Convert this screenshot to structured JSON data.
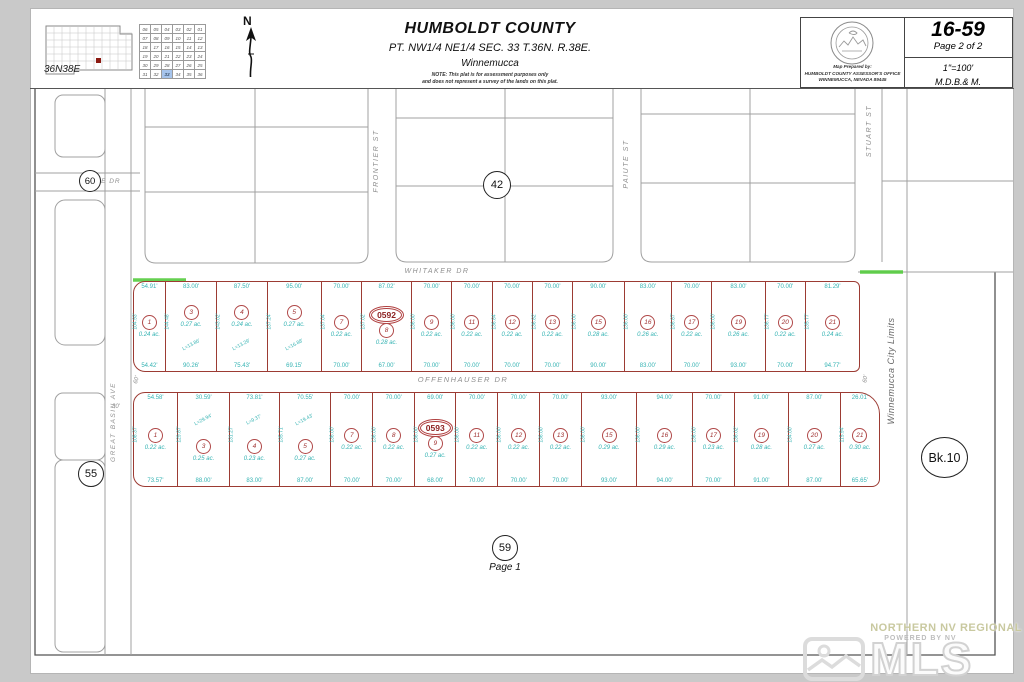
{
  "header": {
    "township_label": "36N38E",
    "north_label": "N",
    "section_grid": {
      "rows": [
        [
          "06",
          "05",
          "04",
          "03",
          "02",
          "01"
        ],
        [
          "07",
          "08",
          "09",
          "10",
          "11",
          "12"
        ],
        [
          "18",
          "17",
          "16",
          "15",
          "14",
          "13"
        ],
        [
          "19",
          "20",
          "21",
          "22",
          "23",
          "24"
        ],
        [
          "30",
          "29",
          "28",
          "27",
          "26",
          "25"
        ],
        [
          "31",
          "32",
          "33",
          "34",
          "35",
          "36"
        ]
      ],
      "highlight": "33"
    },
    "title": "HUMBOLDT COUNTY",
    "subtitle": "PT. NW1/4 NE1/4 SEC. 33 T.36N. R.38E.",
    "city": "Winnemucca",
    "note1": "NOTE: This plat is for assessment purposes only",
    "note2": "and does not represent a survey of the lands on this plat.",
    "prepared1": "Map Prepared by:",
    "prepared2": "HUMBOLDT COUNTY ASSESSOR'S OFFICE",
    "prepared3": "WINNEMUCCA, NEVADA    89445",
    "map_number": "16-59",
    "page": "Page 2 of 2",
    "scale": "1\"=100'",
    "meridian": "M.D.B.& M."
  },
  "streets": {
    "whitaker": "WHITAKER DR",
    "offenhauser": "OFFENHAUSER DR",
    "frontier": "FRONTIER ST",
    "paiute": "PAIUTE ST",
    "stuart": "STUART ST",
    "great_basin": "GREAT BASIN AVE",
    "maple": "MAPLE DR"
  },
  "refs": {
    "north_map": "42",
    "west_map": "55",
    "south_map": "59",
    "south_page": "Page 1",
    "northwest_map": "60",
    "book": "Bk.10"
  },
  "city_limits": "Winnemucca City Limits",
  "dims": {
    "left_offset": "30'",
    "width_left": "60'",
    "width_right": "60'"
  },
  "blocks": [
    {
      "number": "0592",
      "street": "WHITAKER DR",
      "lots": [
        {
          "n": "1",
          "area": "0.24 ac.",
          "top": "54.91'",
          "bottom": "54.42'",
          "side": "104.93'"
        },
        {
          "n": "3",
          "area": "0.27 ac.",
          "top": "83.00'",
          "bottom": "90.26'",
          "side": "144.48'",
          "bottom_extra": "L=13.86'"
        },
        {
          "n": "4",
          "area": "0.24 ac.",
          "top": "87.50'",
          "bottom": "75.43'",
          "side": "143.02'",
          "bottom_extra": "L=13.29'"
        },
        {
          "n": "5",
          "area": "0.27 ac.",
          "top": "95.00'",
          "bottom": "69.15'",
          "side": "137.24'",
          "bottom_extra": "L=16.88'"
        },
        {
          "n": "7",
          "area": "0.22 ac.",
          "top": "70.00'",
          "bottom": "70.00'",
          "side": "137.04'"
        },
        {
          "n": "8",
          "area": "0.28 ac.",
          "top": "87.02'",
          "bottom": "67.00'",
          "side": "137.02'",
          "oval": "0592"
        },
        {
          "n": "9",
          "area": "0.22 ac.",
          "top": "70.00'",
          "bottom": "70.00'",
          "side": "136.00'"
        },
        {
          "n": "11",
          "area": "0.22 ac.",
          "top": "70.00'",
          "bottom": "70.00'",
          "side": "136.00'"
        },
        {
          "n": "12",
          "area": "0.22 ac.",
          "top": "70.00'",
          "bottom": "70.00'",
          "side": "136.84'"
        },
        {
          "n": "13",
          "area": "0.22 ac.",
          "top": "70.00'",
          "bottom": "70.00'",
          "side": "136.82'"
        },
        {
          "n": "15",
          "area": "0.28 ac.",
          "top": "90.00'",
          "bottom": "90.00'",
          "side": "136.00'"
        },
        {
          "n": "16",
          "area": "0.26 ac.",
          "top": "83.00'",
          "bottom": "83.00'",
          "side": "136.00'"
        },
        {
          "n": "17",
          "area": "0.22 ac.",
          "top": "70.00'",
          "bottom": "70.00'",
          "side": "136.87'"
        },
        {
          "n": "19",
          "area": "0.26 ac.",
          "top": "83.00'",
          "bottom": "93.00'",
          "side": "136.00'"
        },
        {
          "n": "20",
          "area": "0.22 ac.",
          "top": "70.00'",
          "bottom": "70.00'",
          "side": "136.77'"
        },
        {
          "n": "21",
          "area": "0.24 ac.",
          "top": "81.29'",
          "bottom": "94.77'",
          "side": "135.77'"
        }
      ]
    },
    {
      "number": "0593",
      "street": "OFFENHAUSER DR",
      "lots": [
        {
          "n": "1",
          "area": "0.22 ac.",
          "top": "54.58'",
          "bottom": "73.57'",
          "side": "108.37'"
        },
        {
          "n": "3",
          "area": "0.25 ac.",
          "top": "30.59'",
          "bottom": "88.00'",
          "side": "129.87'",
          "top_extra": "L=29.94'"
        },
        {
          "n": "4",
          "area": "0.23 ac.",
          "top": "73.81'",
          "bottom": "83.00'",
          "side": "131.27'",
          "top_extra": "L=9.37'"
        },
        {
          "n": "5",
          "area": "0.27 ac.",
          "top": "70.55'",
          "bottom": "87.00'",
          "side": "135.71'",
          "top_extra": "L=19.43'"
        },
        {
          "n": "7",
          "area": "0.22 ac.",
          "top": "70.00'",
          "bottom": "70.00'",
          "side": "136.00'"
        },
        {
          "n": "8",
          "area": "0.22 ac.",
          "top": "70.00'",
          "bottom": "70.00'",
          "side": "136.00'"
        },
        {
          "n": "9",
          "area": "0.27 ac.",
          "top": "69.00'",
          "bottom": "68.00'",
          "side": "136.00'",
          "oval": "0593"
        },
        {
          "n": "11",
          "area": "0.22 ac.",
          "top": "70.00'",
          "bottom": "70.00'",
          "side": "136.00'"
        },
        {
          "n": "12",
          "area": "0.22 ac.",
          "top": "70.00'",
          "bottom": "70.00'",
          "side": "136.00'"
        },
        {
          "n": "13",
          "area": "0.22 ac.",
          "top": "70.00'",
          "bottom": "70.00'",
          "side": "136.00'"
        },
        {
          "n": "15",
          "area": "0.29 ac.",
          "top": "93.00'",
          "bottom": "93.00'",
          "side": "136.00'"
        },
        {
          "n": "16",
          "area": "0.29 ac.",
          "top": "94.00'",
          "bottom": "94.00'",
          "side": "136.00'"
        },
        {
          "n": "17",
          "area": "0.23 ac.",
          "top": "70.00'",
          "bottom": "70.00'",
          "side": "136.00'"
        },
        {
          "n": "19",
          "area": "0.28 ac.",
          "top": "91.00'",
          "bottom": "91.00'",
          "side": "136.02'"
        },
        {
          "n": "20",
          "area": "0.27 ac.",
          "top": "87.00'",
          "bottom": "87.00'",
          "side": "134.00'"
        },
        {
          "n": "21",
          "area": "0.30 ac.",
          "top": "26.01'",
          "bottom": "65.65'",
          "side": "115.94'"
        }
      ]
    }
  ],
  "watermark": {
    "brand": "NORTHERN NV REGIONAL",
    "powered": "POWERED BY NV",
    "logo": "MLS"
  },
  "colors": {
    "lot_line": "#9c3b33",
    "dim_text": "#35b3b3",
    "lot_number": "#a03333",
    "street_text": "#8f8f8f",
    "parcel_line": "#a0a0a0",
    "green_highlight": "#55cc3f",
    "section_highlight": "#a6c4ec"
  }
}
